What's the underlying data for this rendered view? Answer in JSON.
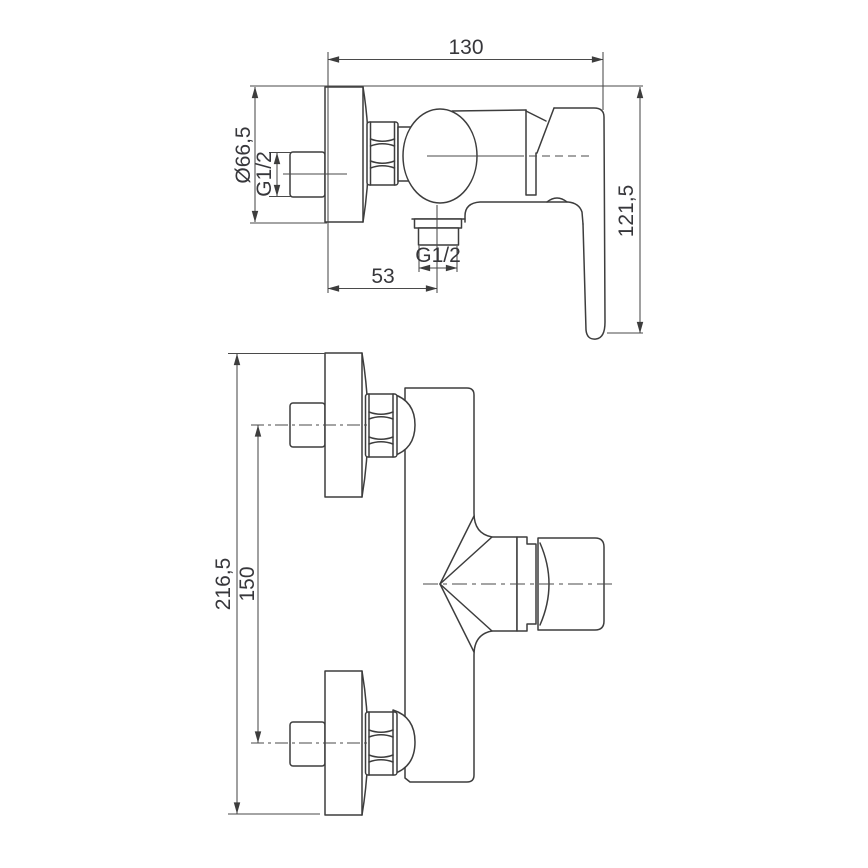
{
  "page": {
    "background": "#ffffff"
  },
  "drawing": {
    "type": "technical-dimension-drawing",
    "subject": "wall-mounted single-lever shower mixer, side and front elevation",
    "colors": {
      "object_line": "#3d3d3d",
      "dimension_line": "#4a4a4a",
      "text": "#37373b",
      "background": "#ffffff"
    },
    "side_view": {
      "width_label": "130",
      "height_label": "121,5",
      "flange_diameter_label": "Ø66,5",
      "inlet_thread_label": "G1/2",
      "outlet_thread_label": "G1/2",
      "outlet_offset_label": "53"
    },
    "front_view": {
      "overall_height_label": "216,5",
      "connection_centers_label": "150"
    }
  }
}
